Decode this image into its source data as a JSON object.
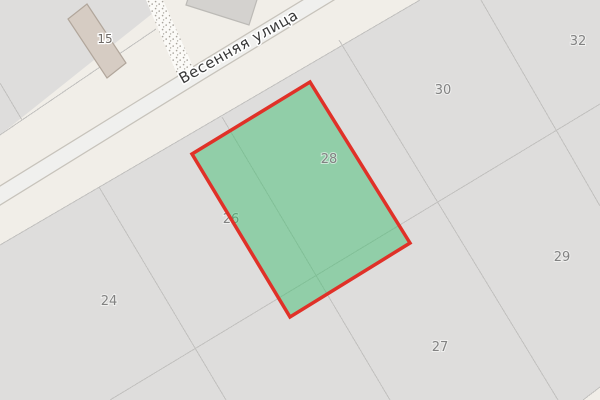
{
  "map": {
    "street_name": "Весенняя улица",
    "labels": {
      "b15": "15",
      "p24": "24",
      "p26": "26",
      "p27": "27",
      "p28": "28",
      "p29": "29",
      "p30": "30",
      "p32": "32"
    },
    "selected_parcel_number": "28"
  },
  "colors": {
    "land": "#f1eee8",
    "residential": "#dedddc",
    "parcel_line": "#c2c1bf",
    "road_fill": "#f0f0ee",
    "road_casing": "#c7c3bb",
    "path_fill": "#fbfaf7",
    "path_dot": "#a9a49c",
    "building_fill": "#d6ccc3",
    "building_stroke": "#b1a69b",
    "building2_fill": "#d4d2cf",
    "building2_stroke": "#bcbab6",
    "highlight_fill": "#3cbe6e",
    "highlight_stroke": "#e03128",
    "parcel_label_color": "#828282",
    "building_label_color": "#6e6a66",
    "street_label_color": "#383838"
  }
}
